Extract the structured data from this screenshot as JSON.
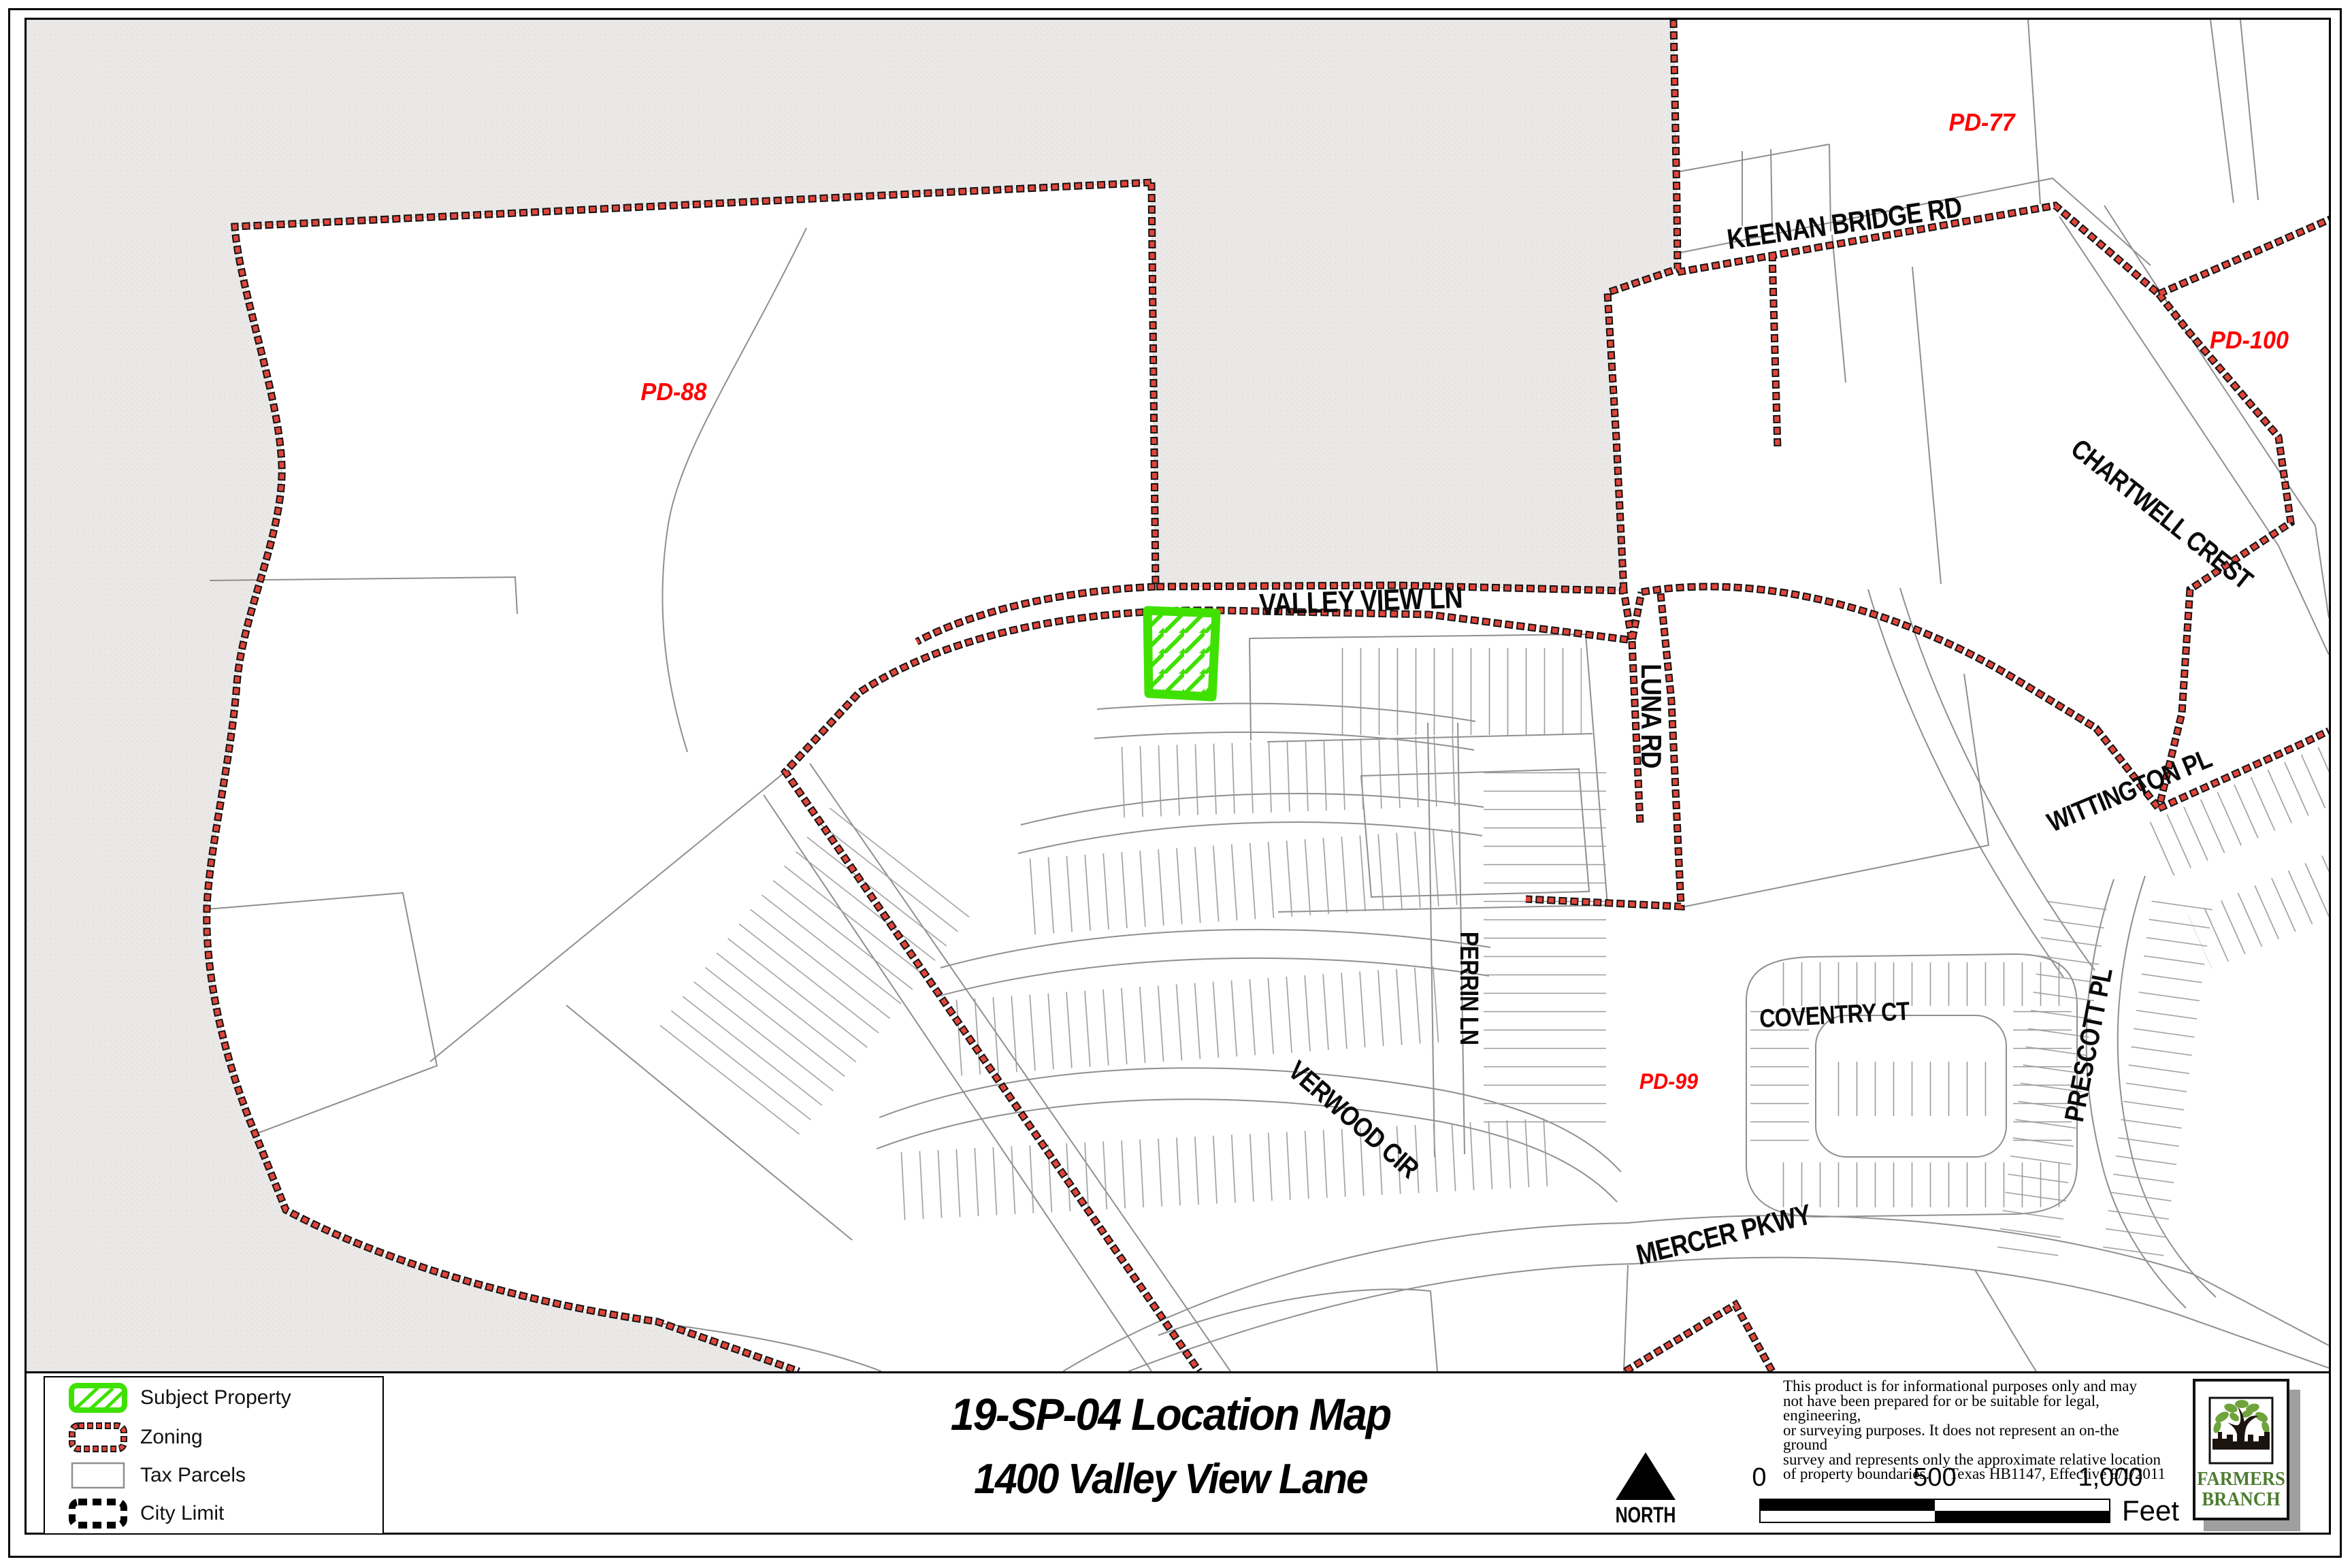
{
  "title": {
    "line1": "19-SP-04 Location Map",
    "line2": "1400 Valley View Lane"
  },
  "legend": {
    "items": [
      {
        "label": "Subject Property",
        "swatch": "green-hatch-box"
      },
      {
        "label": "Zoning",
        "swatch": "red-dashed-box"
      },
      {
        "label": "Tax Parcels",
        "swatch": "gray-outline-box"
      },
      {
        "label": "City Limit",
        "swatch": "black-dashed-box"
      }
    ]
  },
  "north_arrow": {
    "label": "NORTH"
  },
  "scale_bar": {
    "tick0": "0",
    "tick1": "500",
    "tick2": "1,000",
    "unit": "Feet"
  },
  "disclaimer": {
    "line1": "This product is for informational purposes only and may",
    "line2": "not have been prepared for or be suitable for legal, engineering,",
    "line3": "or surveying purposes. It does not represent an on-the ground",
    "line4": "survey and represents only the approximate relative location",
    "line5_left": "of property boundaries.",
    "line5_right": "Texas HB1147, Effective 9/1/2011"
  },
  "logo": {
    "name_line1": "FARMERS",
    "name_line2": "BRANCH"
  },
  "map": {
    "roads": {
      "valley_view": "VALLEY VIEW LN",
      "keenan": "KEENAN BRIDGE RD",
      "luna": "LUNA RD",
      "chartwell": "CHARTWELL CREST",
      "wittington": "WITTINGTON PL",
      "perrin": "PERRIN LN",
      "verwood": "VERWOOD CIR",
      "coventry": "COVENTRY CT",
      "prescott": "PRESCOTT PL",
      "mercer": "MERCER PKWY"
    },
    "zones": {
      "pd77": "PD-77",
      "pd88": "PD-88",
      "pd99": "PD-99",
      "pd100": "PD-100"
    },
    "colors": {
      "zoning_red": "#E2453A",
      "subject_green": "#3FE100",
      "outside_city_gray": "#EAE9E7",
      "parcel_gray": "#8F8F8F",
      "zone_label_red": "#FF0000",
      "logo_green": "#4E7C31"
    }
  }
}
